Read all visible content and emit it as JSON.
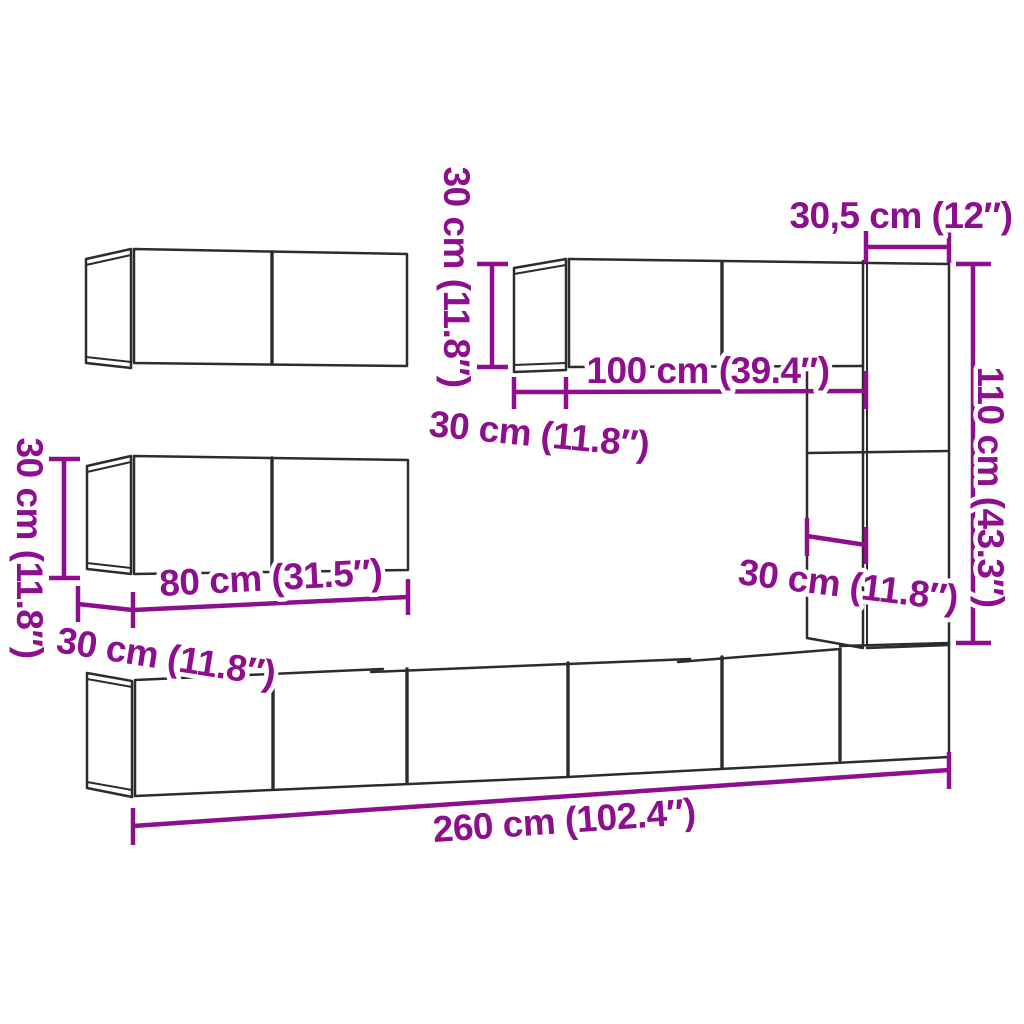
{
  "diagram": {
    "kind": "wall-mounted TV cabinet set dimension drawing",
    "background_color": "#ffffff",
    "outline_color": "#2d2b2b",
    "accent_color": "#8e0f8d"
  },
  "labels": {
    "upper_cabinet_height": "30 cm (11.8″)",
    "left_cabinet_height": "30 cm (11.8″)",
    "upper_right_cabinet_depth": "30 cm (11.8″)",
    "upper_right_cabinet_width": "100 cm (39.4″)",
    "tall_cabinet_width": "30,5 cm (12″)",
    "right_column_height": "110 cm (43.3″)",
    "tall_cabinet_depth": "30 cm (11.8″)",
    "left_cabinet_width": "80 cm (31.5″)",
    "left_cabinet_depth": "30 cm (11.8″)",
    "total_width": "260 cm (102.4″)"
  }
}
